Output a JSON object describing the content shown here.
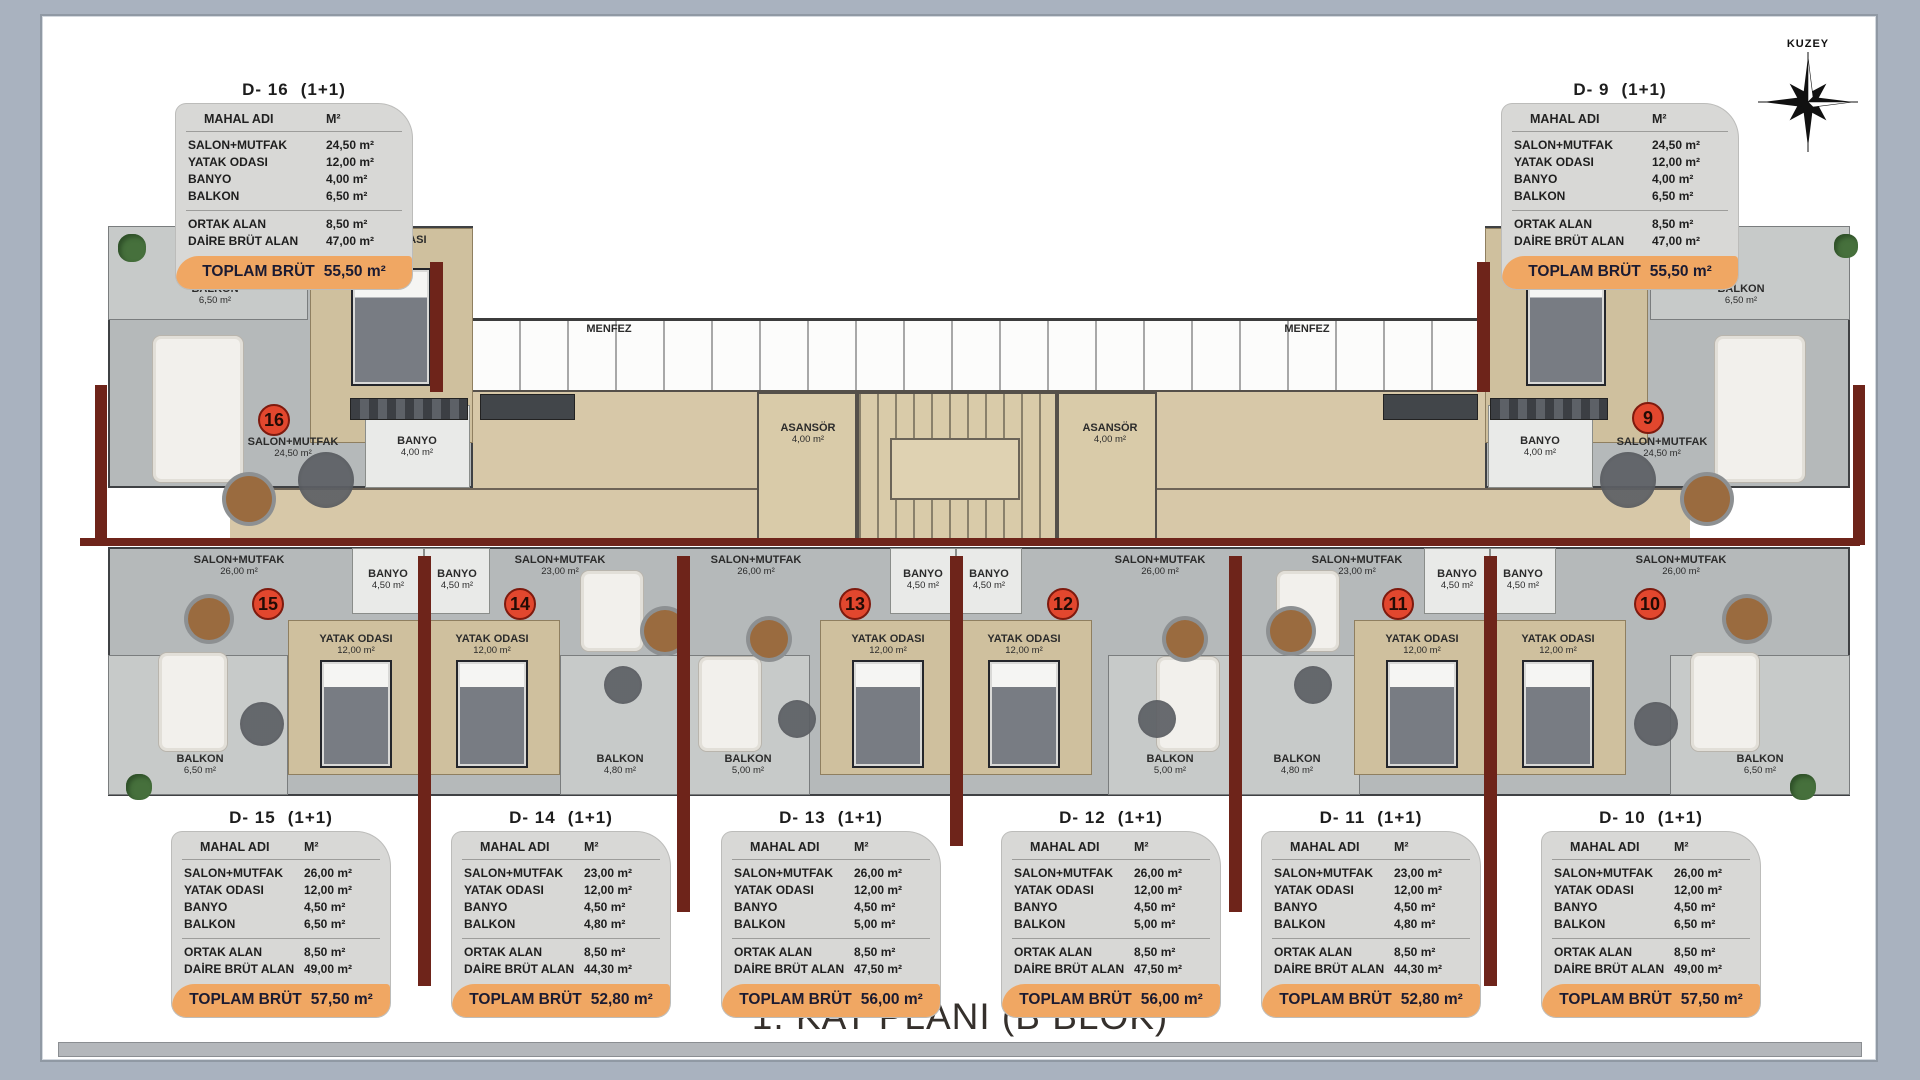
{
  "page": {
    "title": "1. KAT PLANI (B BLOK)",
    "compass_label": "KUZEY"
  },
  "table": {
    "header_name": "MAHAL ADI",
    "header_unit": "M²",
    "row_labels": [
      "SALON+MUTFAK",
      "YATAK ODASI",
      "BANYO",
      "BALKON"
    ],
    "summary_labels": [
      "ORTAK ALAN",
      "DAİRE BRÜT ALAN"
    ],
    "total_label": "TOPLAM BRÜT"
  },
  "units": [
    {
      "id": "D- 16",
      "type": "(1+1)",
      "areas": {
        "salon_mutfak": "24,50 m²",
        "yatak_odasi": "12,00 m²",
        "banyo": "4,00 m²",
        "balkon": "6,50 m²",
        "ortak_alan": "8,50 m²",
        "daire_brut_alan": "47,00 m²",
        "toplam_brut": "55,50 m²"
      }
    },
    {
      "id": "D- 9",
      "type": "(1+1)",
      "areas": {
        "salon_mutfak": "24,50 m²",
        "yatak_odasi": "12,00 m²",
        "banyo": "4,00 m²",
        "balkon": "6,50 m²",
        "ortak_alan": "8,50 m²",
        "daire_brut_alan": "47,00 m²",
        "toplam_brut": "55,50 m²"
      }
    },
    {
      "id": "D- 15",
      "type": "(1+1)",
      "areas": {
        "salon_mutfak": "26,00 m²",
        "yatak_odasi": "12,00 m²",
        "banyo": "4,50 m²",
        "balkon": "6,50 m²",
        "ortak_alan": "8,50 m²",
        "daire_brut_alan": "49,00 m²",
        "toplam_brut": "57,50 m²"
      }
    },
    {
      "id": "D- 14",
      "type": "(1+1)",
      "areas": {
        "salon_mutfak": "23,00 m²",
        "yatak_odasi": "12,00 m²",
        "banyo": "4,50 m²",
        "balkon": "4,80 m²",
        "ortak_alan": "8,50 m²",
        "daire_brut_alan": "44,30 m²",
        "toplam_brut": "52,80 m²"
      }
    },
    {
      "id": "D- 13",
      "type": "(1+1)",
      "areas": {
        "salon_mutfak": "26,00 m²",
        "yatak_odasi": "12,00 m²",
        "banyo": "4,50 m²",
        "balkon": "5,00 m²",
        "ortak_alan": "8,50 m²",
        "daire_brut_alan": "47,50 m²",
        "toplam_brut": "56,00 m²"
      }
    },
    {
      "id": "D- 12",
      "type": "(1+1)",
      "areas": {
        "salon_mutfak": "26,00 m²",
        "yatak_odasi": "12,00 m²",
        "banyo": "4,50 m²",
        "balkon": "5,00 m²",
        "ortak_alan": "8,50 m²",
        "daire_brut_alan": "47,50 m²",
        "toplam_brut": "56,00 m²"
      }
    },
    {
      "id": "D- 11",
      "type": "(1+1)",
      "areas": {
        "salon_mutfak": "23,00 m²",
        "yatak_odasi": "12,00 m²",
        "banyo": "4,50 m²",
        "balkon": "4,80 m²",
        "ortak_alan": "8,50 m²",
        "daire_brut_alan": "44,30 m²",
        "toplam_brut": "52,80 m²"
      }
    },
    {
      "id": "D- 10",
      "type": "(1+1)",
      "areas": {
        "salon_mutfak": "26,00 m²",
        "yatak_odasi": "12,00 m²",
        "banyo": "4,50 m²",
        "balkon": "6,50 m²",
        "ortak_alan": "8,50 m²",
        "daire_brut_alan": "49,00 m²",
        "toplam_brut": "57,50 m²"
      }
    }
  ],
  "plan": {
    "unit_markers": [
      {
        "number": "16",
        "x": 274,
        "y": 420
      },
      {
        "number": "9",
        "x": 1648,
        "y": 418
      },
      {
        "number": "15",
        "x": 268,
        "y": 604
      },
      {
        "number": "14",
        "x": 520,
        "y": 604
      },
      {
        "number": "13",
        "x": 855,
        "y": 604
      },
      {
        "number": "12",
        "x": 1063,
        "y": 604
      },
      {
        "number": "11",
        "x": 1398,
        "y": 604
      },
      {
        "number": "10",
        "x": 1650,
        "y": 604
      }
    ],
    "room_labels": [
      {
        "name": "BALKON",
        "area": "6,50 m²",
        "x": 215,
        "y": 295
      },
      {
        "name": "YATAK ODASI",
        "area": "12,00 m²",
        "x": 390,
        "y": 246
      },
      {
        "name": "SALON+MUTFAK",
        "area": "24,50 m²",
        "x": 293,
        "y": 448
      },
      {
        "name": "BANYO",
        "area": "4,00 m²",
        "x": 417,
        "y": 447
      },
      {
        "name": "MENFEZ",
        "area": "",
        "x": 609,
        "y": 330
      },
      {
        "name": "ASANSÖR",
        "area": "4,00 m²",
        "x": 808,
        "y": 434
      },
      {
        "name": "ASANSÖR",
        "area": "4,00 m²",
        "x": 1110,
        "y": 434
      },
      {
        "name": "MENFEZ",
        "area": "",
        "x": 1307,
        "y": 330
      },
      {
        "name": "BANYO",
        "area": "4,00 m²",
        "x": 1540,
        "y": 447
      },
      {
        "name": "SALON+MUTFAK",
        "area": "24,50 m²",
        "x": 1662,
        "y": 448
      },
      {
        "name": "YATAK ODASI",
        "area": "12,00 m²",
        "x": 1568,
        "y": 246
      },
      {
        "name": "BALKON",
        "area": "6,50 m²",
        "x": 1741,
        "y": 295
      },
      {
        "name": "SALON+MUTFAK",
        "area": "26,00 m²",
        "x": 239,
        "y": 566
      },
      {
        "name": "BANYO",
        "area": "4,50 m²",
        "x": 388,
        "y": 580
      },
      {
        "name": "YATAK ODASI",
        "area": "12,00 m²",
        "x": 356,
        "y": 645
      },
      {
        "name": "BALKON",
        "area": "6,50 m²",
        "x": 200,
        "y": 765
      },
      {
        "name": "BANYO",
        "area": "4,50 m²",
        "x": 457,
        "y": 580
      },
      {
        "name": "SALON+MUTFAK",
        "area": "23,00 m²",
        "x": 560,
        "y": 566
      },
      {
        "name": "YATAK ODASI",
        "area": "12,00 m²",
        "x": 492,
        "y": 645
      },
      {
        "name": "BALKON",
        "area": "4,80 m²",
        "x": 620,
        "y": 765
      },
      {
        "name": "SALON+MUTFAK",
        "area": "26,00 m²",
        "x": 756,
        "y": 566
      },
      {
        "name": "BANYO",
        "area": "4,50 m²",
        "x": 923,
        "y": 580
      },
      {
        "name": "YATAK ODASI",
        "area": "12,00 m²",
        "x": 888,
        "y": 645
      },
      {
        "name": "BALKON",
        "area": "5,00 m²",
        "x": 748,
        "y": 765
      },
      {
        "name": "BANYO",
        "area": "4,50 m²",
        "x": 989,
        "y": 580
      },
      {
        "name": "SALON+MUTFAK",
        "area": "26,00 m²",
        "x": 1160,
        "y": 566
      },
      {
        "name": "YATAK ODASI",
        "area": "12,00 m²",
        "x": 1024,
        "y": 645
      },
      {
        "name": "BALKON",
        "area": "5,00 m²",
        "x": 1170,
        "y": 765
      },
      {
        "name": "SALON+MUTFAK",
        "area": "23,00 m²",
        "x": 1357,
        "y": 566
      },
      {
        "name": "BANYO",
        "area": "4,50 m²",
        "x": 1457,
        "y": 580
      },
      {
        "name": "YATAK ODASI",
        "area": "12,00 m²",
        "x": 1422,
        "y": 645
      },
      {
        "name": "BALKON",
        "area": "4,80 m²",
        "x": 1297,
        "y": 765
      },
      {
        "name": "BANYO",
        "area": "4,50 m²",
        "x": 1523,
        "y": 580
      },
      {
        "name": "SALON+MUTFAK",
        "area": "26,00 m²",
        "x": 1681,
        "y": 566
      },
      {
        "name": "YATAK ODASI",
        "area": "12,00 m²",
        "x": 1558,
        "y": 645
      },
      {
        "name": "BALKON",
        "area": "6,50 m²",
        "x": 1760,
        "y": 765
      }
    ],
    "walls": [
      {
        "x": 80,
        "y": 538,
        "w": 1780,
        "h": 8
      },
      {
        "x": 418,
        "y": 556,
        "w": 13,
        "h": 430
      },
      {
        "x": 677,
        "y": 556,
        "w": 13,
        "h": 356
      },
      {
        "x": 950,
        "y": 556,
        "w": 13,
        "h": 290
      },
      {
        "x": 1229,
        "y": 556,
        "w": 13,
        "h": 356
      },
      {
        "x": 1484,
        "y": 556,
        "w": 13,
        "h": 430
      },
      {
        "x": 430,
        "y": 262,
        "w": 13,
        "h": 130
      },
      {
        "x": 1477,
        "y": 262,
        "w": 13,
        "h": 130
      },
      {
        "x": 95,
        "y": 385,
        "w": 12,
        "h": 160
      },
      {
        "x": 1853,
        "y": 385,
        "w": 12,
        "h": 160
      }
    ],
    "furniture": [
      {
        "type": "bed",
        "x": 351,
        "y": 268,
        "w": 80,
        "h": 118
      },
      {
        "type": "bed",
        "x": 1526,
        "y": 268,
        "w": 80,
        "h": 118
      },
      {
        "type": "bed",
        "x": 320,
        "y": 660,
        "w": 72,
        "h": 108
      },
      {
        "type": "bed",
        "x": 456,
        "y": 660,
        "w": 72,
        "h": 108
      },
      {
        "type": "bed",
        "x": 852,
        "y": 660,
        "w": 72,
        "h": 108
      },
      {
        "type": "bed",
        "x": 988,
        "y": 660,
        "w": 72,
        "h": 108
      },
      {
        "type": "bed",
        "x": 1386,
        "y": 660,
        "w": 72,
        "h": 108
      },
      {
        "type": "bed",
        "x": 1522,
        "y": 660,
        "w": 72,
        "h": 108
      },
      {
        "type": "sofa",
        "x": 152,
        "y": 335,
        "w": 92,
        "h": 148
      },
      {
        "type": "sofa",
        "x": 1714,
        "y": 335,
        "w": 92,
        "h": 148
      },
      {
        "type": "sofa",
        "x": 158,
        "y": 652,
        "w": 70,
        "h": 100
      },
      {
        "type": "sofa",
        "x": 580,
        "y": 570,
        "w": 64,
        "h": 82
      },
      {
        "type": "sofa",
        "x": 698,
        "y": 656,
        "w": 64,
        "h": 96
      },
      {
        "type": "sofa",
        "x": 1156,
        "y": 656,
        "w": 64,
        "h": 96
      },
      {
        "type": "sofa",
        "x": 1276,
        "y": 570,
        "w": 64,
        "h": 82
      },
      {
        "type": "sofa",
        "x": 1690,
        "y": 652,
        "w": 70,
        "h": 100
      },
      {
        "type": "rug",
        "x": 298,
        "y": 452,
        "d": 56
      },
      {
        "type": "rug",
        "x": 1600,
        "y": 452,
        "d": 56
      },
      {
        "type": "rug",
        "x": 240,
        "y": 702,
        "d": 44
      },
      {
        "type": "rug",
        "x": 604,
        "y": 666,
        "d": 38
      },
      {
        "type": "rug",
        "x": 778,
        "y": 700,
        "d": 38
      },
      {
        "type": "rug",
        "x": 1138,
        "y": 700,
        "d": 38
      },
      {
        "type": "rug",
        "x": 1294,
        "y": 666,
        "d": 38
      },
      {
        "type": "rug",
        "x": 1634,
        "y": 702,
        "d": 44
      },
      {
        "type": "table",
        "x": 226,
        "y": 476,
        "d": 46
      },
      {
        "type": "table",
        "x": 1684,
        "y": 476,
        "d": 46
      },
      {
        "type": "table",
        "x": 188,
        "y": 598,
        "d": 42
      },
      {
        "type": "table",
        "x": 644,
        "y": 610,
        "d": 42
      },
      {
        "type": "table",
        "x": 750,
        "y": 620,
        "d": 38
      },
      {
        "type": "table",
        "x": 1166,
        "y": 620,
        "d": 38
      },
      {
        "type": "table",
        "x": 1270,
        "y": 610,
        "d": 42
      },
      {
        "type": "table",
        "x": 1726,
        "y": 598,
        "d": 42
      },
      {
        "type": "plant",
        "x": 118,
        "y": 234,
        "d": 28
      },
      {
        "type": "plant",
        "x": 1834,
        "y": 234,
        "d": 24
      },
      {
        "type": "plant",
        "x": 126,
        "y": 774,
        "d": 26
      },
      {
        "type": "plant",
        "x": 1790,
        "y": 774,
        "d": 26
      },
      {
        "type": "wardrobe",
        "x": 350,
        "y": 398,
        "w": 118,
        "h": 22
      },
      {
        "type": "wardrobe",
        "x": 1490,
        "y": 398,
        "w": 118,
        "h": 22
      },
      {
        "type": "counter",
        "x": 480,
        "y": 394,
        "w": 95,
        "h": 26
      },
      {
        "type": "counter",
        "x": 1383,
        "y": 394,
        "w": 95,
        "h": 26
      }
    ]
  }
}
